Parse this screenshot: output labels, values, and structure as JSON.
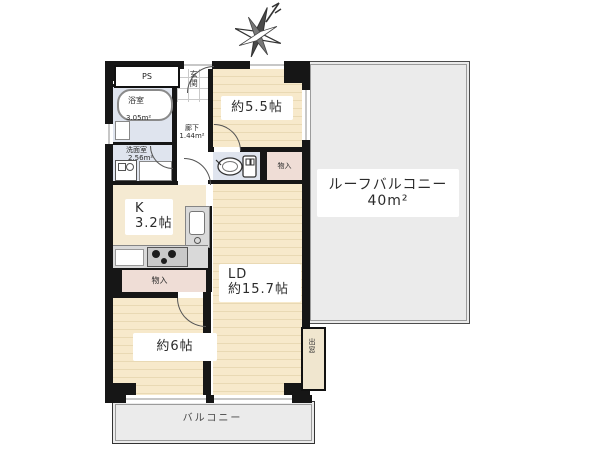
{
  "compass": {
    "icon": "north-arrow"
  },
  "rooms": {
    "ps": {
      "label": "PS"
    },
    "entrance": {
      "label": "玄関"
    },
    "bathroom": {
      "label": "浴室",
      "area": "3.05m²"
    },
    "washroom": {
      "label": "洗面室",
      "area": "2.56m²"
    },
    "corridor": {
      "label": "廊下",
      "area": "1.44m²"
    },
    "bedroom_5_5": {
      "label": "約5.5帖"
    },
    "hall_closet": {
      "label": "物入"
    },
    "kitchen": {
      "label": "K",
      "size": "3.2帖"
    },
    "kitchen_closet": {
      "label": "物入"
    },
    "living_dining": {
      "label": "LD",
      "size": "約15.7帖"
    },
    "bedroom_6": {
      "label": "約6帖"
    },
    "bay_window": {
      "label": "出窓"
    },
    "balcony": {
      "label": "バルコニー"
    },
    "roof_balcony": {
      "label": "ルーフバルコニー",
      "area": "40m²"
    }
  },
  "colors": {
    "wall": "#161616",
    "tatami_floor": "#f7e9cb",
    "wet_area": "#dfe4ee",
    "closet": "#efddd6",
    "balcony": "#ebebeb"
  }
}
